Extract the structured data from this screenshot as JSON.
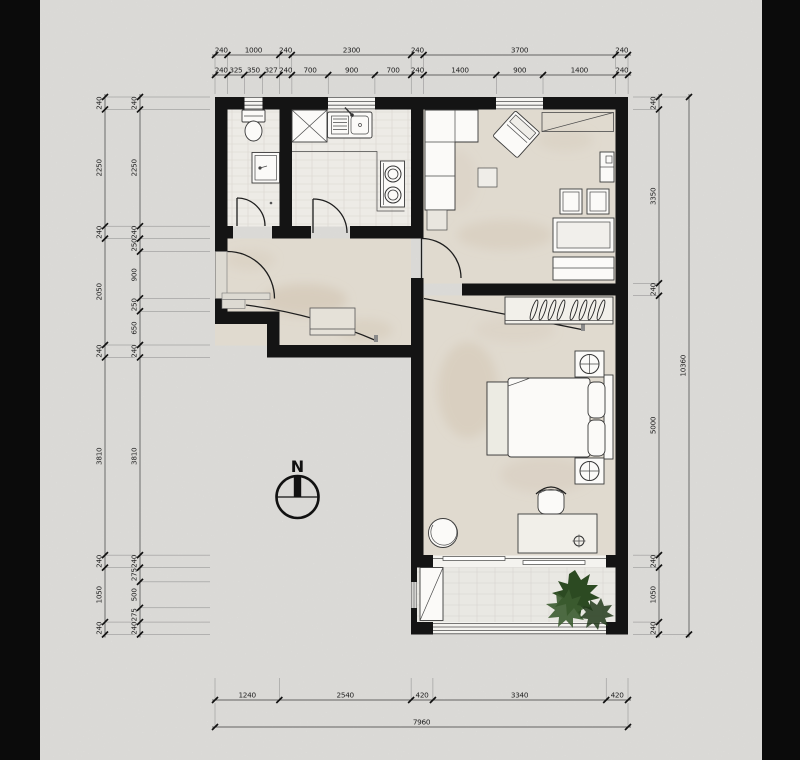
{
  "compass": {
    "label": "N"
  },
  "dimensions": {
    "top_outer": {
      "side": "top, outer row",
      "values": [
        "240",
        "1000",
        "240",
        "2300",
        "240",
        "3700",
        "240"
      ]
    },
    "top_inner": {
      "side": "top, inner row",
      "values": [
        "240",
        "325",
        "350",
        "327",
        "240",
        "700",
        "900",
        "700",
        "240",
        "1400",
        "900",
        "1400",
        "240"
      ]
    },
    "left_outer": {
      "side": "left, outer column",
      "values": [
        "240",
        "2250",
        "240",
        "2050",
        "240",
        "3810",
        "240",
        "1050",
        "240"
      ]
    },
    "left_inner": {
      "side": "left, inner column",
      "values": [
        "240",
        "2250",
        "240",
        "250",
        "900",
        "250",
        "650",
        "240",
        "3810",
        "240",
        "275",
        "500",
        "275",
        "240"
      ]
    },
    "right_inner": {
      "side": "right, inner column",
      "values": [
        "240",
        "3350",
        "240",
        "5000",
        "240",
        "1050",
        "240"
      ]
    },
    "right_outer": {
      "side": "right, outer column",
      "values": [
        "10360"
      ]
    },
    "bottom_inner": {
      "side": "bottom, inner row",
      "values": [
        "1240",
        "2540",
        "420",
        "3340",
        "420"
      ]
    },
    "bottom_outer": {
      "side": "bottom, outer row",
      "values": [
        "7960"
      ]
    }
  },
  "plan": {
    "total_width_mm": "7960",
    "total_height_mm": "10360",
    "rooms": [
      "bathroom",
      "kitchen",
      "living-room",
      "entry-hall",
      "bedroom",
      "balcony"
    ]
  }
}
